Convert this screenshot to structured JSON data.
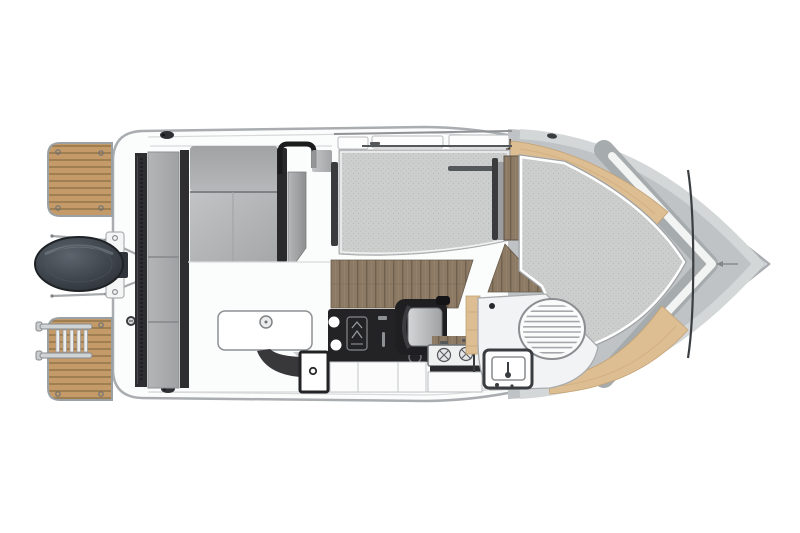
{
  "diagram": {
    "title": "Motor boat deck floor plan, top-down view, bow to the right",
    "type": "boat-floor-plan",
    "view": "top-down",
    "orientation": "bow-right",
    "parts": {
      "hull": "Hull and side decks",
      "foredeck": "Foredeck",
      "bow_trim_port": "Bow gunwale wood trim (port)",
      "bow_trim_starboard": "Bow gunwale wood trim (starboard)",
      "v_berth_cushion": "Bow berth / sunpad cushion",
      "saloon_mat": "Saloon dinette berth cushion",
      "grab_handle": "Cabin grab handle",
      "cabin_sole": "Cabin walnut floor",
      "companionway_step": "Companionway walnut step",
      "galley_counter": "Galley counter",
      "galley_control_panel": "Galley control panel",
      "sink_bowls": "Galley sink bowls",
      "stove": "Two-burner stove",
      "galley_cabinets": "Galley cabinet fronts",
      "helm_seat": "Helm seat",
      "head_compartment": "Head compartment moulding",
      "toilet": "Marine toilet",
      "vanity_sink": "Head vanity sink",
      "wheelhouse_windows": "Wheelhouse side windows",
      "door_frame": "Wheelhouse sliding door frame",
      "cockpit_floor": "Cockpit floor",
      "cockpit_bench": "Cockpit L-shaped bench seat",
      "cockpit_backrest": "Cockpit bench backrest",
      "cockpit_side_seat": "Cockpit side seat panel",
      "aft_bench": "Aft bench cushion",
      "aft_locker": "Aft locker front",
      "deck_hatch": "Cockpit deck hatch with latch",
      "side_console": "Cockpit side console",
      "step_panel": "Cockpit step panel",
      "transom": "Transom board",
      "outboard_engine": "Outboard engine",
      "engine_bracket": "Engine mounting bracket",
      "swim_platform_port": "Swim platform (port)",
      "swim_platform_starboard": "Swim platform (starboard)",
      "boarding_ladder": "Telescopic boarding ladder",
      "grab_rails": "Transom grab rails",
      "cleat_port": "Mooring cleat (port aft)",
      "cleat_starboard": "Mooring cleat (starboard aft)",
      "cleat_bow_port": "Mooring cleat (port bow)",
      "cleat_bow_starboard": "Mooring cleat (starboard bow)",
      "fuel_filler": "Deck filler cap",
      "bow_mark": "Bow hatch arrow mark"
    }
  },
  "palette": {
    "background": "#ffffff",
    "hull-stroke": "#a9adb0",
    "deck": "#fbfcfc",
    "line-light": "#d7d9da",
    "line-mid": "#9aa0a3",
    "charcoal": "#232326",
    "dark-strip": "#2e2e31",
    "teak": "#c49b68",
    "teak-line": "#8e7047",
    "trim": "#ddbd92",
    "trim-line": "#c3a274",
    "walnut": "#8c7a65",
    "walnut-dark": "#6d5e4c",
    "mat": "#cccdcd",
    "mat-dot": "#b7b8b8",
    "cushion": "#b6b7b9",
    "bow-gray": "#bfc3c6",
    "bow-band": "#a6abae",
    "steel": "#d0d3d5",
    "engine": "#343a41",
    "white": "#ffffff"
  }
}
